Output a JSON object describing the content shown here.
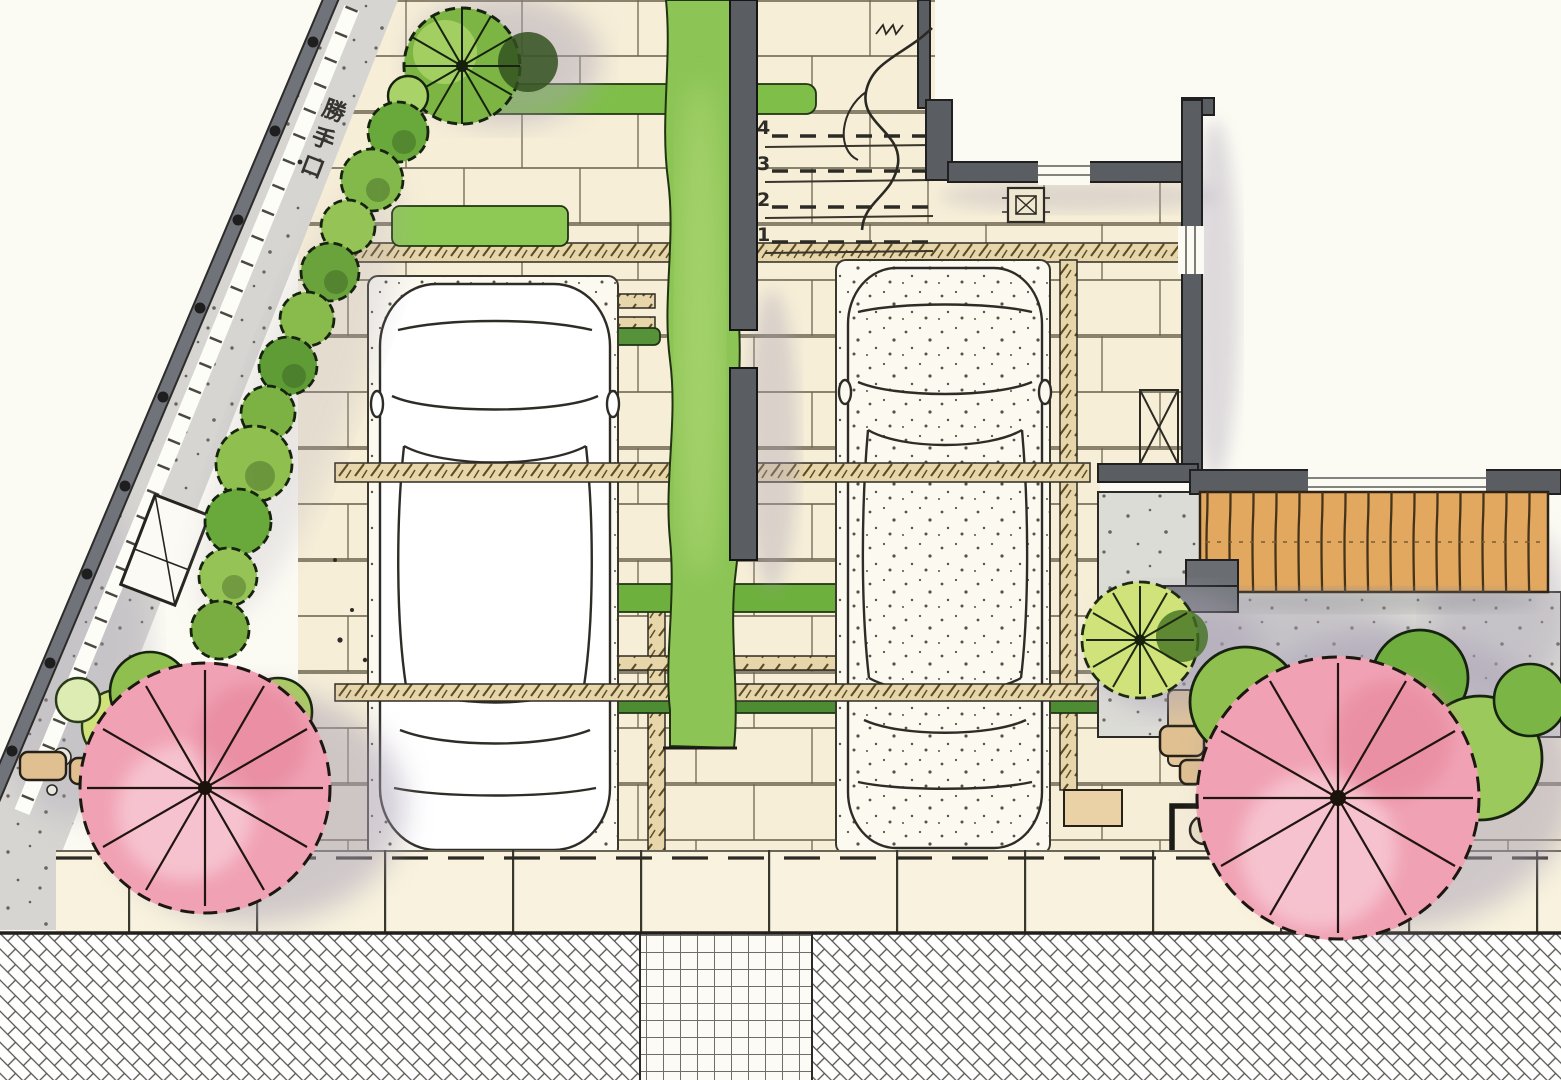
{
  "plan": {
    "labels": {
      "back_door": "勝手口",
      "step_numbers": [
        "4",
        "3",
        "2",
        "1"
      ]
    },
    "palette": {
      "paper": "#fcfbf3",
      "tile": "#f6eed7",
      "tile_line": "#6d6550",
      "lawn": "#8cc456",
      "hedge_dark": "#4f8f33",
      "hedge_mid": "#6fae3e",
      "hedge_light": "#9cc95c",
      "blossom_pink": "#f0a2b4",
      "blossom_pink_light": "#f7c6d2",
      "deck_wood": "#e2a860",
      "wall_gray": "#5a5e62",
      "road_gray": "#d6d5d1",
      "concrete_gray": "#dcdcd6",
      "joint_band": "#e7d6aa",
      "stone_tan": "#e0c091",
      "shadow_violet": "#a79fb4",
      "ink": "#26241f"
    }
  }
}
